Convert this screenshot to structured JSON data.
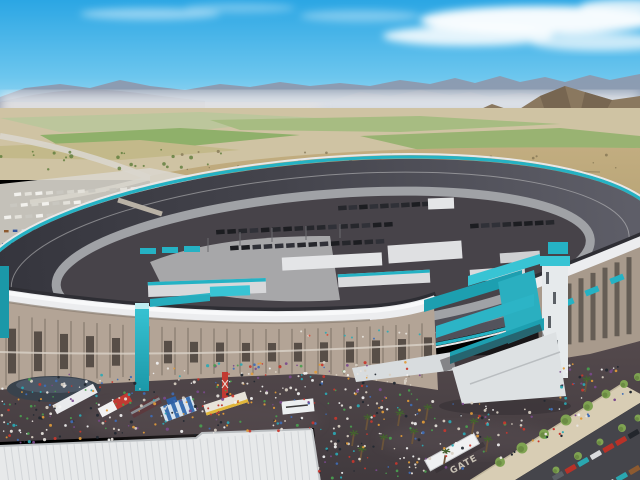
{
  "scene": {
    "name": "phoenix-raceway-aerial-rendering",
    "gate_label": "GATE"
  },
  "palette": {
    "sky_top": "#2ba6e4",
    "sky_mid": "#6cc6ee",
    "sky_horizon": "#cfeaf6",
    "cloud": "#ffffff",
    "mountain_far": "#8e97ab",
    "mountain_mid": "#7f8699",
    "mountain_right": "#9aa2b2",
    "haze": "#eef1f4",
    "haze_warm": "#efe6dd",
    "mountain_brown": "#8a785f",
    "mountain_brown_dark": "#6a5a47",
    "field_tan": "#cfc3a3",
    "field_green_bright": "#8fb06a",
    "field_green": "#a7bc82",
    "field_green_soft": "#b9c79b",
    "field_tan2": "#c3b98a",
    "road": "#d9d6cd",
    "hill_light": "#c2ad80",
    "hill_dark": "#a39263",
    "hill_speckle": "#7c6f4f",
    "terrace": "#8f815d",
    "track_dark": "#34343c",
    "track_mid": "#44444c",
    "track_light": "#60606a",
    "apron": "#a0a2a6",
    "infield": "#474349",
    "infield_concrete": "#a7a7a9",
    "teal": "#25b2c4",
    "teal_dark": "#1b98a8",
    "teal_bright": "#38c4d4",
    "wall_white": "#e8e8e8",
    "building_white": "#e4e5e7",
    "grandstand_roof": "#ecedef",
    "grandstand_structure": "#b3a496",
    "grandstand_structure_right": "#a89a8c",
    "structure_shadow": "#46403a",
    "plaza_top": "#564b4e",
    "plaza_bottom": "#413a3e",
    "expo_roof": "#e7e9ea",
    "expo_roof_rib": "#d2d5d8",
    "sidewalk": "#d8cdb4",
    "tree_green": "#7fa352",
    "tree_dark": "#5d7c3a",
    "palm_trunk": "#6b543a",
    "parking_asphalt": "#45454b",
    "tent_dome": "#39424c",
    "tent_dome_top": "#4d5866",
    "tent_blue": "#3a6fb0",
    "vendor_red": "#c23a32",
    "vendor_yellow": "#e0b63a",
    "trailer_white": "#eceff0",
    "gate_text_color": "#d5cec0"
  },
  "procedural": {
    "seed": 20,
    "crowd_count": 560,
    "sidewalk_people_count": 22,
    "hill_speckle_count": 150,
    "field_tree_count": 26,
    "crowd_colors": [
      "#e8e4de",
      "#c8372e",
      "#3f6db5",
      "#e09a3a",
      "#2ba8b4",
      "#222831",
      "#f2f2f2",
      "#7a4a8c",
      "#4a9e4f",
      "#d8cfc2"
    ],
    "rv_colors": [
      "#f2f1ed",
      "#e3e1da",
      "#d6d4cc",
      "#c9c7c0"
    ],
    "car_colors": [
      "#b83228",
      "#2aa7b0",
      "#31549e",
      "#23262c",
      "#d9dadc",
      "#8c5a30",
      "#5b6066"
    ],
    "hauler_colors": [
      "#1c1d21",
      "#26272c",
      "#303138"
    ],
    "seat_dot_colors": [
      "#d94f3a",
      "#e8b63a",
      "#3f6db5",
      "#2ba8b4",
      "#e8e4de"
    ]
  }
}
